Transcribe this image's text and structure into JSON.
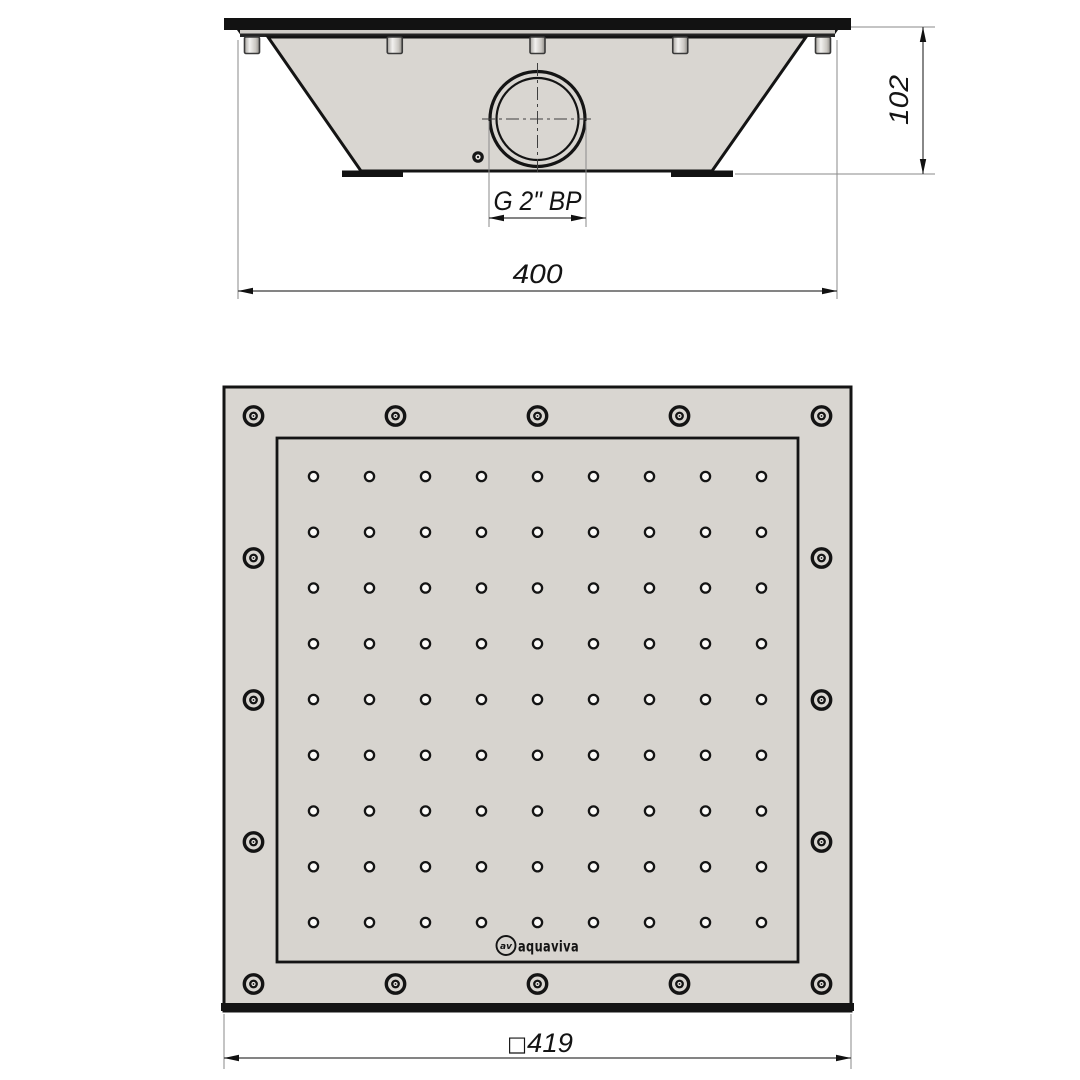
{
  "drawing": {
    "side_view": {
      "thread_label": "G 2\" BP",
      "width_dim": "400",
      "height_dim": "102",
      "stud_count": 5
    },
    "plan_view": {
      "square_symbol": "□",
      "size_dim": "419",
      "hole_grid": {
        "rows": 9,
        "cols": 9
      },
      "perimeter_screws": {
        "per_side": 5,
        "total": 16
      },
      "logo": {
        "monogram": "av",
        "text": "aquaviva"
      }
    },
    "colors": {
      "plate": "#d9d6d1",
      "panel": "#d7d4cf",
      "line": "#141414",
      "dim_line": "#3a3a3a",
      "ext_line": "#8a8a8a",
      "background": "#ffffff"
    }
  }
}
